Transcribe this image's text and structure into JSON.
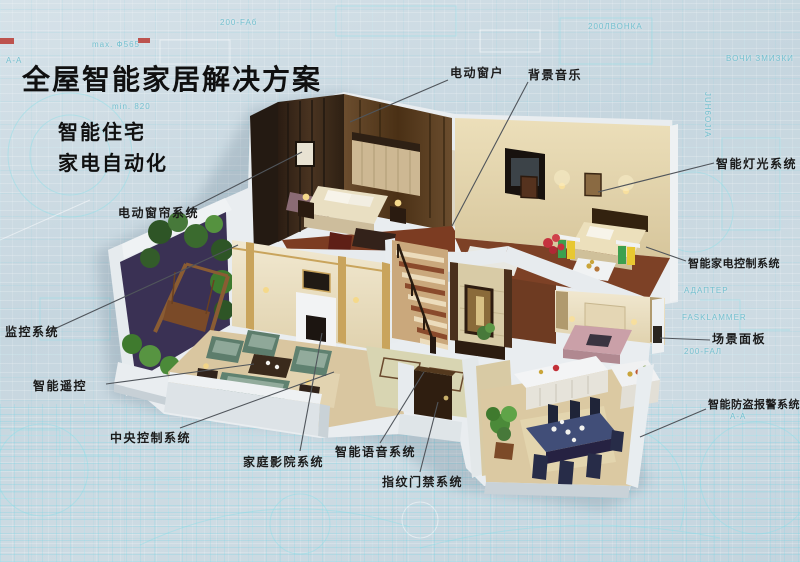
{
  "page": {
    "title": "全屋智能家居解决方案",
    "subtitle_lines": [
      "智能住宅",
      "家电自动化"
    ]
  },
  "callouts": {
    "electric_window": "电动窗户",
    "background_music": "背景音乐",
    "smart_lighting": "智能灯光系统",
    "appliance_control": "智能家电控制系统",
    "scene_panel": "场景面板",
    "burglar_alarm": "智能防盗报警系统",
    "electric_curtain": "电动窗帘系统",
    "monitoring": "监控系统",
    "smart_remote": "智能遥控",
    "central_control": "中央控制系统",
    "home_theater": "家庭影院系统",
    "voice_system": "智能语音系统",
    "fingerprint_access": "指纹门禁系统"
  },
  "blueprint_texts": [
    "max. Ф565",
    "min. 820",
    "200-FAб",
    "200ЛВОНКА",
    "А-А",
    "АДАПТЕР",
    "FASKLAMMER",
    "ВОЧИ ЗМИЗКИ",
    "200-FAЛ",
    "JUH6OJIA"
  ],
  "colors": {
    "background": "#c9d9e2",
    "blueprint_line": "#9fdde8",
    "title_text": "#101010",
    "label_text": "#1b1b1b",
    "leader_line": "#50555b",
    "house_shell": "#e9edf0",
    "wood_dark": "#35261a",
    "floor_brown": "#7c3c22",
    "sofa_teal": "#5f8170",
    "dining_blue": "#414e78",
    "red_mark": "#b93a33"
  }
}
